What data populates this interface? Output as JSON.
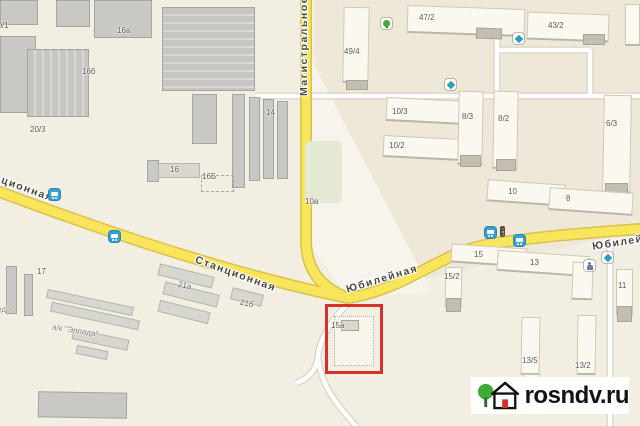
{
  "canvas": {
    "width": 640,
    "height": 426
  },
  "colors": {
    "land": "#f2efe2",
    "land_right": "#efe8d8",
    "land_wedge": "#f7f4ec",
    "road_main_fill": "#f8e55b",
    "road_main_casing": "#d9c14d",
    "road_minor_fill": "#ffffff",
    "road_minor_casing": "#d8d3c5",
    "building_fill": "#fbf8f0",
    "building_shadow": "#b9b5a8",
    "industrial_fill": "#c9c8c4",
    "garage_fill": "#d8d6d0",
    "park_green": "#e3e9d2",
    "highlight_red": "#d8312b",
    "bus_icon_blue": "#37a0d5",
    "poi_teal": "#2aa0b4",
    "poi_green": "#3faa35",
    "logo_text": "#131313",
    "logo_door_red": "#cf3227"
  },
  "streets": {
    "vertical": {
      "name": "Магистральное"
    },
    "diag_left": {
      "name": "Станционная"
    },
    "diag_left_fragment": {
      "name": "Станционная"
    },
    "diag_right": {
      "name": "Юбилейная"
    },
    "right_edge": {
      "name": "Юбилейная"
    }
  },
  "buildings": {
    "labels": [
      {
        "text": "20/1"
      },
      {
        "text": "16а"
      },
      {
        "text": "16б"
      },
      {
        "text": "20/3"
      },
      {
        "text": "14"
      },
      {
        "text": "16"
      },
      {
        "text": "16Б"
      },
      {
        "text": "10а"
      },
      {
        "text": "49/4"
      },
      {
        "text": "47/2"
      },
      {
        "text": "43/2"
      },
      {
        "text": "10/3"
      },
      {
        "text": "10/2"
      },
      {
        "text": "8/3"
      },
      {
        "text": "8/2"
      },
      {
        "text": "6/3"
      },
      {
        "text": "10"
      },
      {
        "text": "8"
      },
      {
        "text": "15"
      },
      {
        "text": "13"
      },
      {
        "text": "15/2"
      },
      {
        "text": "11"
      },
      {
        "text": "13/5"
      },
      {
        "text": "13/2"
      },
      {
        "text": "17"
      },
      {
        "text": "21а"
      },
      {
        "text": "21б"
      },
      {
        "text": "ед\""
      },
      {
        "text": "а/к \"Эллада\""
      }
    ]
  },
  "highlight": {
    "parcel_label": "15а"
  },
  "watermark": {
    "site": "rosndv.ru"
  },
  "icons": {
    "bus_stop": "bus in blue rounded square",
    "traffic_light": "vertical traffic light",
    "trees": "green tree on white square",
    "education": "teal symbol on white square",
    "playground": "person figure on white square",
    "logo_house": "house with red door and green tree"
  }
}
